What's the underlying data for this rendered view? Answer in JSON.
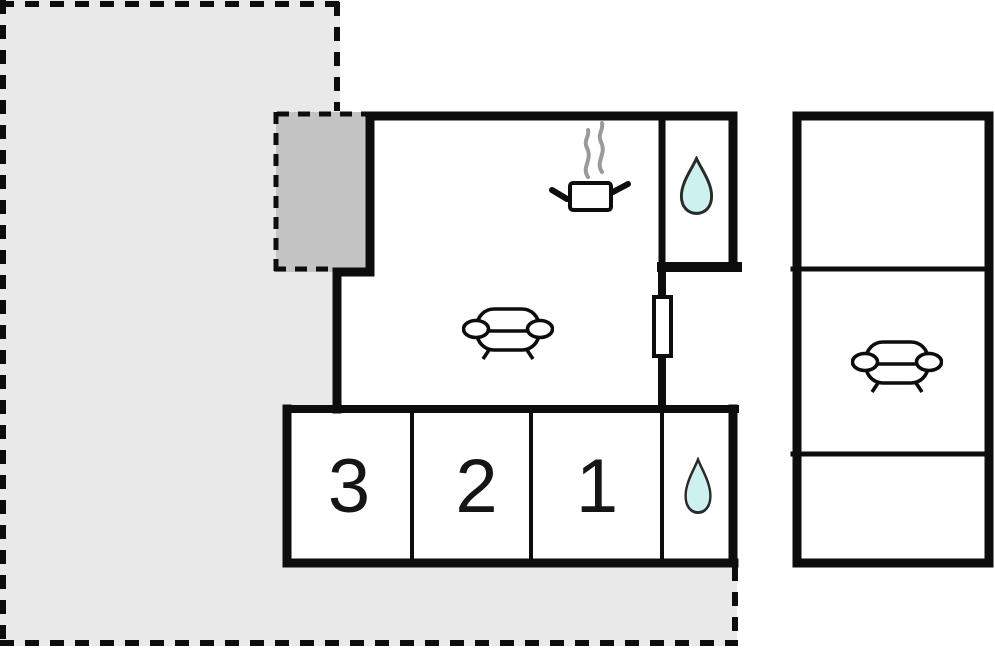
{
  "plan": {
    "bedroom_labels": [
      "3",
      "2",
      "1"
    ],
    "rooms": {
      "kitchen_icon": "cooking-pot-icon",
      "living_room_icon": "sofa-icon",
      "bathroom_icon": "water-drop-icon",
      "shower_room_icon": "water-drop-icon",
      "annex_lounge_icon": "sofa-icon"
    },
    "colors": {
      "terrace_fill": "#e9e9e9",
      "patch_fill": "#c4c4c4",
      "wall": "#0d0d0d",
      "water_fill": "#ccf1ef",
      "steam": "#9a9a9a",
      "background": "#ffffff"
    }
  }
}
